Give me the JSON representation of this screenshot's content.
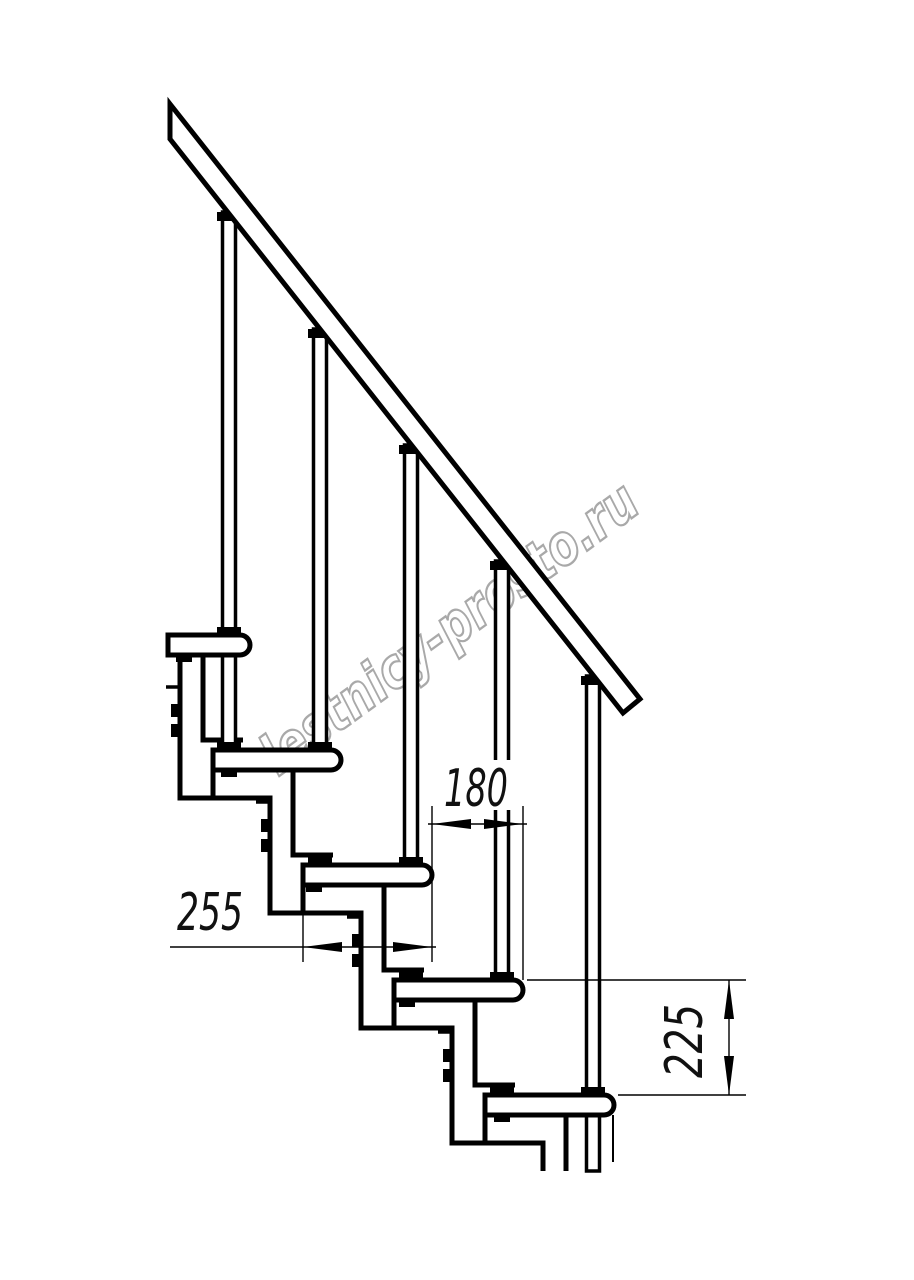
{
  "drawing": {
    "type": "staircase-side-elevation-technical-drawing",
    "background": "#ffffff",
    "line_color": "#000000",
    "watermark": {
      "text": "lestnicy-prosto.ru",
      "color": "#a9a9a9"
    },
    "dimensions": {
      "tread_depth": {
        "value": "255",
        "orientation": "horizontal"
      },
      "step_going": {
        "value": "180",
        "orientation": "horizontal"
      },
      "step_rise": {
        "value": "225",
        "orientation": "vertical"
      }
    },
    "counts": {
      "treads": 5,
      "balusters": 5,
      "handrails": 1
    }
  }
}
